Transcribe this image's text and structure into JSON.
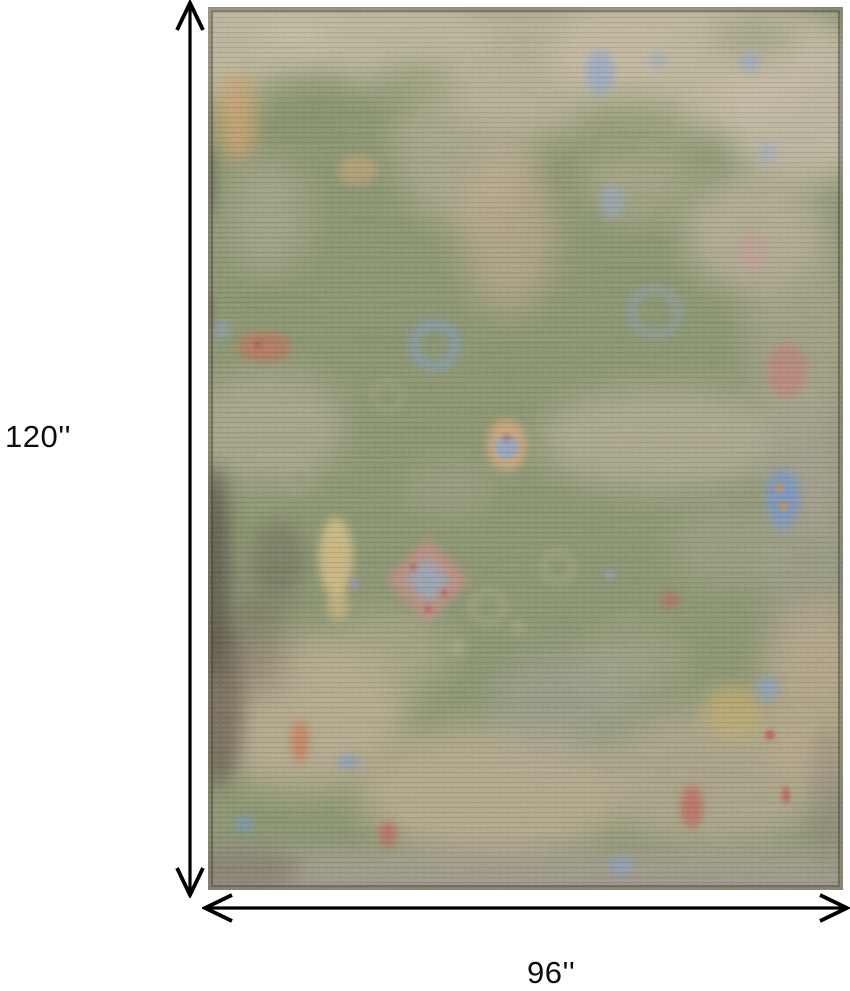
{
  "diagram": {
    "height_label": "120''",
    "width_label": "96''",
    "arrow_color": "#000000",
    "background_color": "#ffffff"
  },
  "rug": {
    "style": "distressed vintage floral area rug, faded green field with beige, tan, blue, rose and gold motifs, worn dark patches along left edge and grey-tan lower border",
    "palette": {
      "field_green": "#87926a",
      "faded_beige": "#c3bba0",
      "warm_tan": "#bcab8e",
      "peach": "#c9ab91",
      "gold": "#c9ae68",
      "accent_blue": "#7e9bd0",
      "accent_rose": "#c57c72",
      "accent_red": "#bf5a50",
      "accent_orange": "#d4a26b",
      "dark_wear": "#4e453b",
      "bottom_band": "#a49c8c"
    }
  }
}
